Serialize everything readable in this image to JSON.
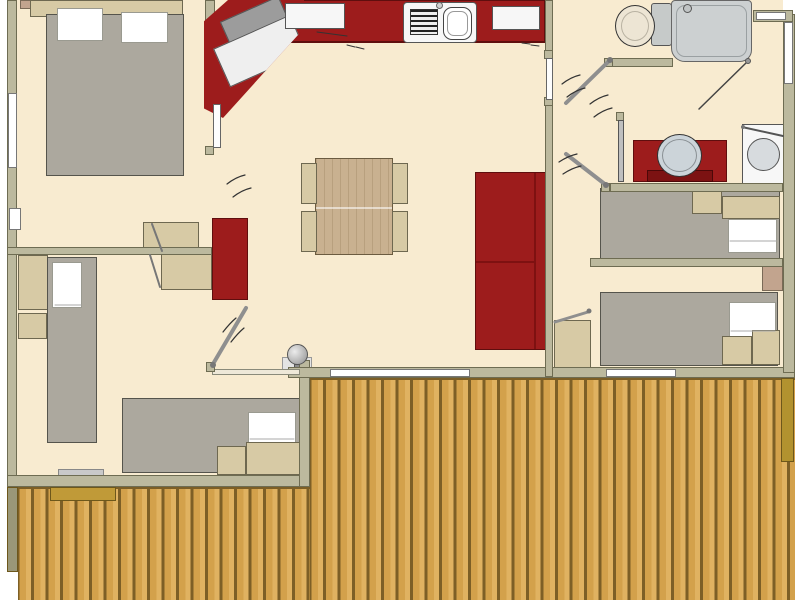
{
  "app": {
    "type": "architectural-floor-plan",
    "subject": "mobile-home / chalet floor plan with wrap-around wooden deck",
    "visible_text": []
  },
  "palette": {
    "floor": "#f8ebd0",
    "wall": "#bcb99e",
    "wallb": "#6e6c52",
    "red": "#9d1c1c",
    "redd": "#5f0e0e",
    "tan": "#d7caa5",
    "tanb": "#6e6850",
    "pinktan": "#c2a48e",
    "bedgrey": "#aca89e",
    "bedb": "#55544c",
    "pillow": "#ffffff",
    "whitebox": "#f7f7f7",
    "wood": "#c9b190",
    "plank": "#d3a14b",
    "plankl": "#e0b261",
    "plankd": "#7d5f26",
    "rail": "#b2922f",
    "step": "#c09a38",
    "fixture": "#ccd0d1",
    "basin": "#ccd4d9"
  },
  "rooms": [
    {
      "name": "master-bedroom",
      "position": "top-left",
      "furniture": [
        "double-bed",
        "two-pillows",
        "headboard-cabinets",
        "bedside-unit",
        "desk-with-chair",
        "left-wall-window",
        "door"
      ]
    },
    {
      "name": "kitchen",
      "position": "top-center",
      "furniture": [
        "red-corner-counter-unit",
        "red-counter",
        "worktop-board",
        "cooktop",
        "sink",
        "upper-cabinet"
      ]
    },
    {
      "name": "wc",
      "position": "top-right-left",
      "furniture": [
        "toilet",
        "door-with-swing"
      ]
    },
    {
      "name": "bathroom",
      "position": "top-right",
      "furniture": [
        "shower-cabin",
        "red-washbasin-vanity",
        "round-basin",
        "washing-machine",
        "door"
      ]
    },
    {
      "name": "living-dining-room",
      "position": "center",
      "furniture": [
        "square-dining-table",
        "four-chairs",
        "red-sofa",
        "red-wardrobe",
        "round-boiler-fixture",
        "sliding-glass-door"
      ]
    },
    {
      "name": "bedroom-left",
      "position": "bottom-left",
      "furniture": [
        "single-bed-vertical",
        "single-bed-horizontal",
        "pillows",
        "bedside-cabinets",
        "desk",
        "door-with-swing",
        "entry-step-with-mat"
      ]
    },
    {
      "name": "bedroom-right-1",
      "position": "right-middle",
      "furniture": [
        "single-bed",
        "headboard-cabinets",
        "pillow",
        "door-with-swing",
        "nightstand-shared"
      ]
    },
    {
      "name": "bedroom-right-2",
      "position": "right-lower",
      "furniture": [
        "single-bed",
        "footboard-cabinets",
        "pillow",
        "small-desk",
        "door",
        "window"
      ]
    },
    {
      "name": "deck",
      "position": "bottom-and-right",
      "furniture": [
        "vertical-wood-planks",
        "edge-railing-strips",
        "entry-step"
      ]
    }
  ],
  "counts": {
    "beds": 5,
    "chairs": 4,
    "interior-door-swings": 6,
    "windows": 6
  }
}
